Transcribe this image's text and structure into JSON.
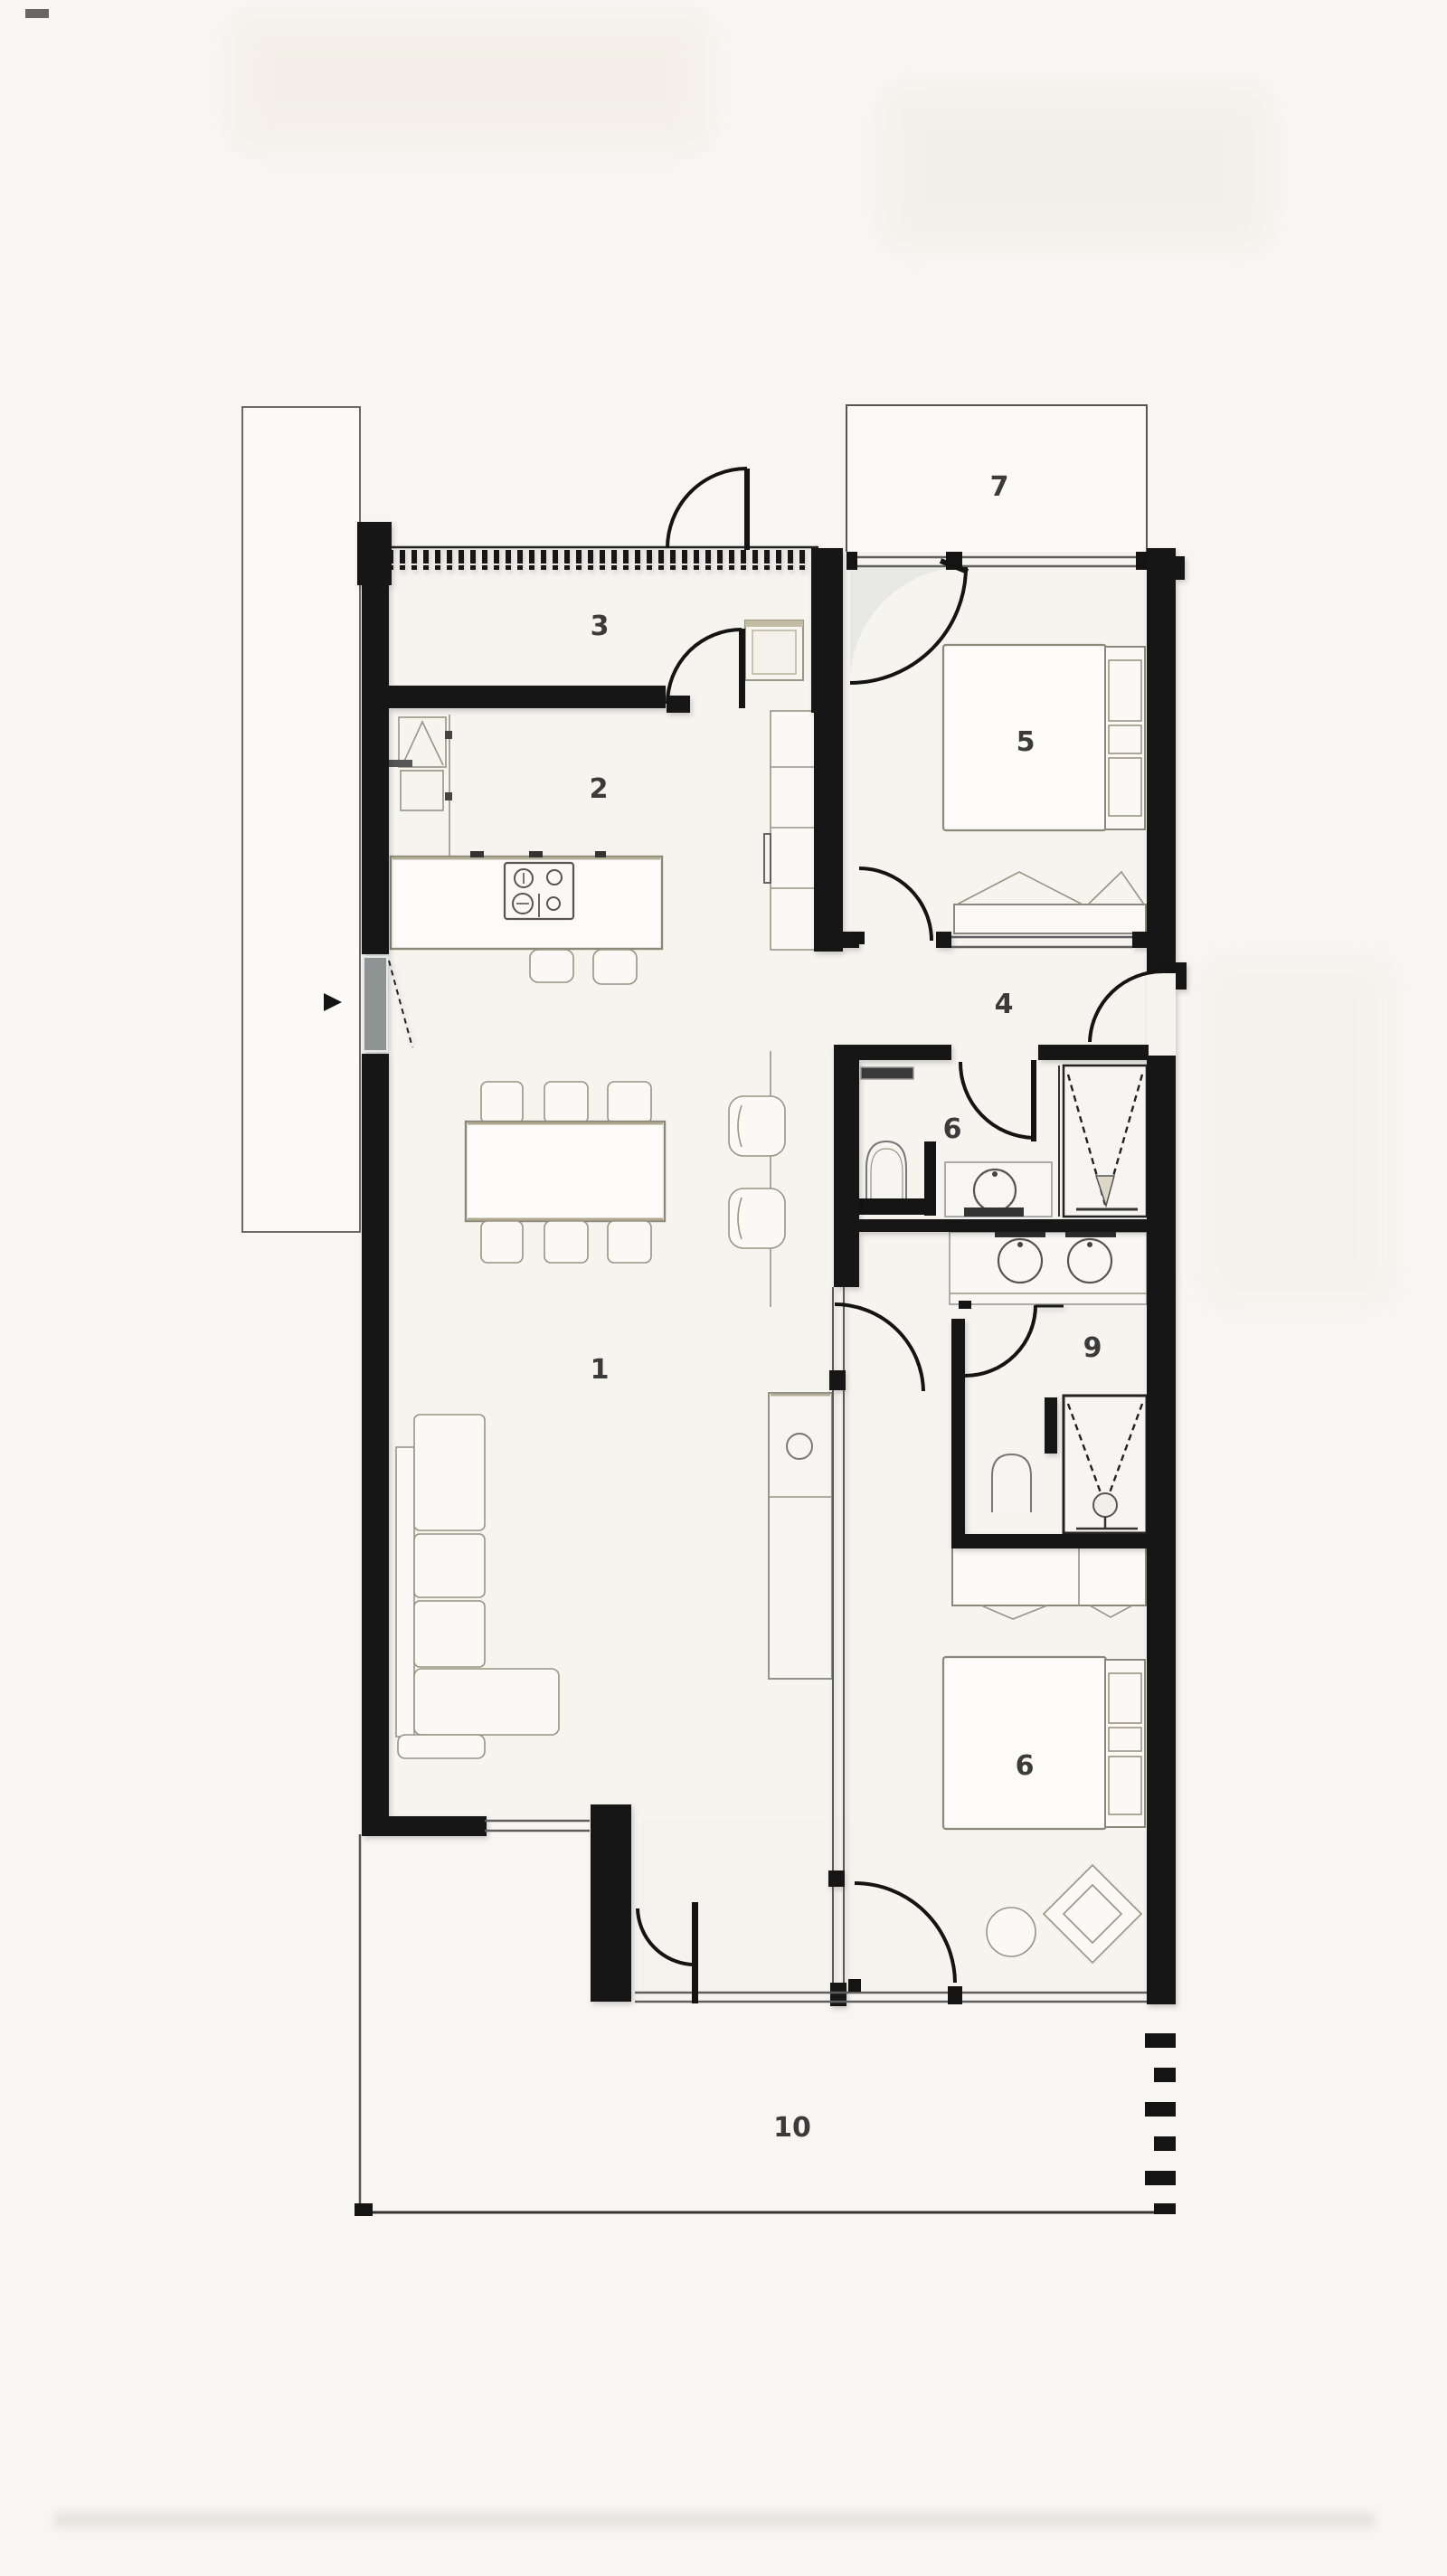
{
  "plan": {
    "rooms": [
      {
        "key": "living-dining",
        "label": "1"
      },
      {
        "key": "kitchen",
        "label": "2"
      },
      {
        "key": "entry-hall",
        "label": "3"
      },
      {
        "key": "corridor",
        "label": "4"
      },
      {
        "key": "bedroom-upper",
        "label": "5"
      },
      {
        "key": "bathroom",
        "label": "6"
      },
      {
        "key": "terrace-upper",
        "label": "7"
      },
      {
        "key": "shower-room",
        "label": "9"
      },
      {
        "key": "bedroom-lower",
        "label": "6"
      },
      {
        "key": "terrace-lower",
        "label": "10"
      }
    ],
    "colors": {
      "wall": "#141414",
      "paper": "#f7f6f2",
      "interior": "#f5f4ef",
      "furniture_line": "#8a8878",
      "accent_beige": "#bfb79c",
      "glazing": "#5f5f5f",
      "label_text": "#3b3b3b"
    }
  }
}
